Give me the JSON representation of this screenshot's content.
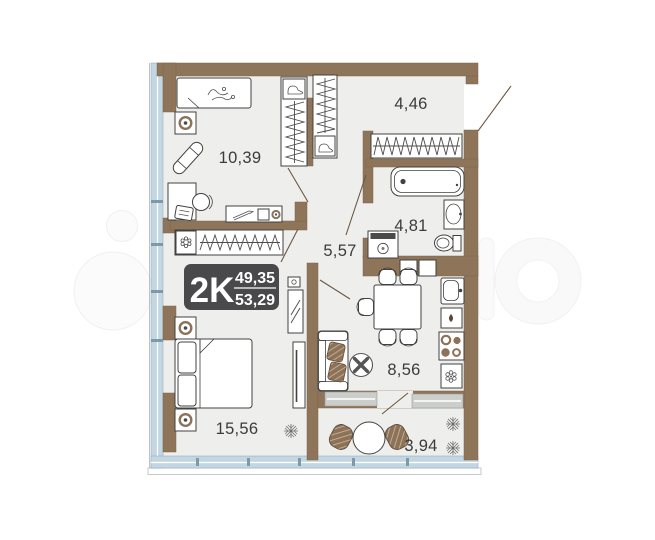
{
  "plan": {
    "badge": {
      "type_label": "2K",
      "upper_area": "49,35",
      "lower_area": "53,29"
    },
    "rooms": [
      {
        "id": "room-top-left",
        "area_label": "10,39"
      },
      {
        "id": "entry-hall",
        "area_label": "4,46"
      },
      {
        "id": "bathroom",
        "area_label": "4,81"
      },
      {
        "id": "corridor",
        "area_label": "5,57"
      },
      {
        "id": "kitchen",
        "area_label": "8,56"
      },
      {
        "id": "bedroom",
        "area_label": "15,56"
      },
      {
        "id": "balcony",
        "area_label": "3,94"
      }
    ],
    "colors": {
      "walls": "#8e7458",
      "floor": "#eeefec",
      "glazing": "#c3d7e2",
      "badge_bg": "#3f3e40",
      "furniture_outline": "#414141",
      "wood_accent": "#8d7258"
    }
  }
}
